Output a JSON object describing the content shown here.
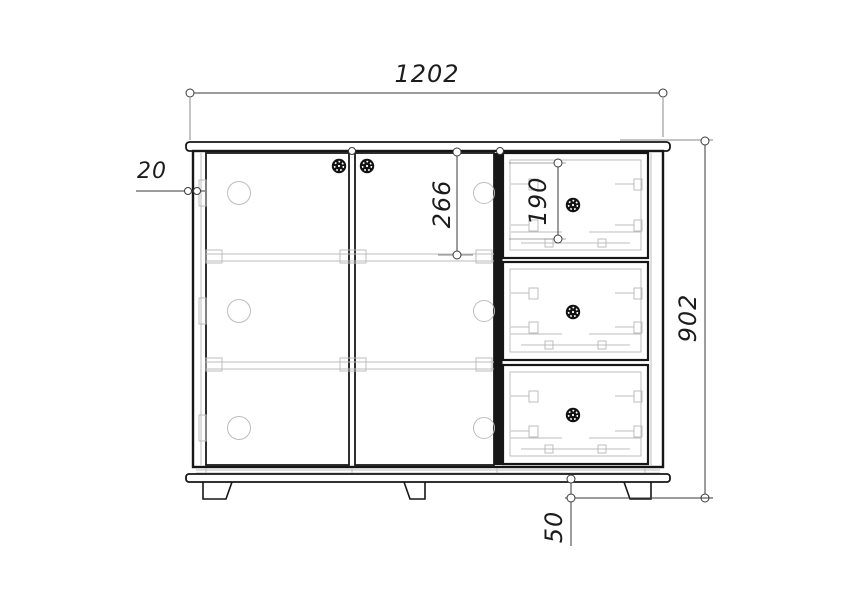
{
  "drawing": {
    "type": "cabinet-front-elevation-technical-drawing",
    "units": "mm",
    "dimensions": {
      "overall_width": "1202",
      "overall_height": "902",
      "side_panel_thickness": "20",
      "top_section_height": "266",
      "drawer_front_height": "190",
      "leg_height": "50"
    },
    "parts": {
      "doors": 2,
      "drawers": 3,
      "legs_visible": 3,
      "hinges_per_door": 3
    },
    "icons": {
      "knob": "knob-icon",
      "hinge": "hinge-icon",
      "dimension_end": "dimension-endpoint-circle"
    },
    "colors": {
      "background": "#ffffff",
      "outline_dark": "#161616",
      "detail_light": "#bcbcbc",
      "dimension_line": "#3a3a3a",
      "text": "#1c1c1c"
    }
  }
}
